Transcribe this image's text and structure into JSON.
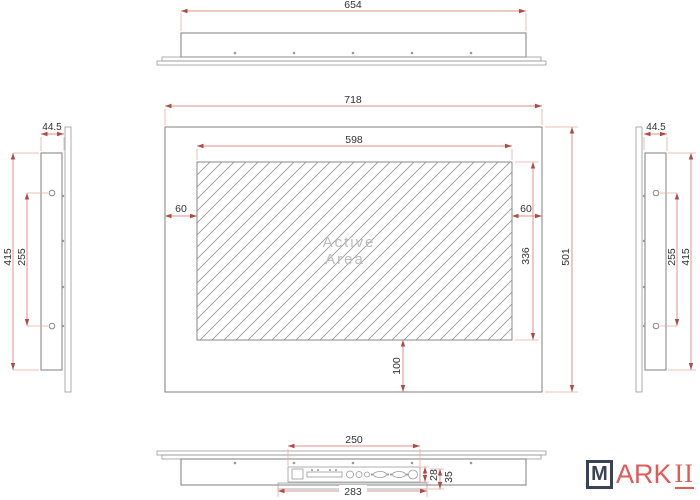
{
  "drawing_type": "panel-display-dimension-drawing",
  "dims": {
    "top_width": "654",
    "front_outer_width": "718",
    "front_active_width": "598",
    "front_margin_left": "60",
    "front_margin_right": "60",
    "front_active_height": "336",
    "front_outer_height": "501",
    "front_margin_bottom": "100",
    "side_depth_left": "44.5",
    "side_height_left": "415",
    "side_hole_spacing_left": "255",
    "side_depth_right": "44.5",
    "side_height_right": "415",
    "side_hole_spacing_right": "255",
    "bottom_io_width": "250",
    "bottom_mount_width": "283",
    "bottom_io_height": "28",
    "bottom_total_height": "35"
  },
  "active_area": {
    "line1": "Active",
    "line2": "Area"
  },
  "logo": {
    "initial": "M",
    "brand_sans": "ARK",
    "brand_suffix": "II"
  },
  "colors": {
    "dimension_line": "#dd918c",
    "dimension_arrow": "#b14a44",
    "geometry_line": "#8a8a8a",
    "dimension_text": "#333333",
    "active_area_text": "#bdbdbd",
    "logo_box": "#3a4258",
    "logo_text": "#e05a56"
  }
}
